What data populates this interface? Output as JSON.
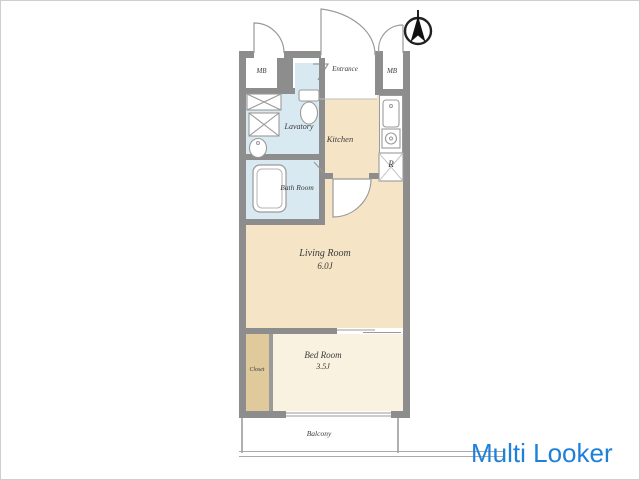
{
  "watermark": {
    "text": "Multi Looker",
    "color": "#1e80d9"
  },
  "plan": {
    "north_indicator": "compass-north-arrow",
    "rooms": {
      "mb_left": "MB",
      "mb_right": "MB",
      "entrance": "Entrance",
      "lavatory": "Lavatory",
      "kitchen": "Kitchen",
      "bath_room": "Bath Room",
      "living_room": {
        "label": "Living Room",
        "size": "6.0J"
      },
      "bed_room": {
        "label": "Bed Room",
        "size": "3.5J"
      },
      "closet": "Closet",
      "balcony": "Balcony",
      "refrigerator_space": "R"
    },
    "colors": {
      "wall": "#8d8d8d",
      "wet_area_floor": "#d9e9f1",
      "main_floor": "#f5e5c6",
      "bedroom_floor": "#f9f2e0",
      "closet_floor": "#e0ca9c"
    }
  }
}
